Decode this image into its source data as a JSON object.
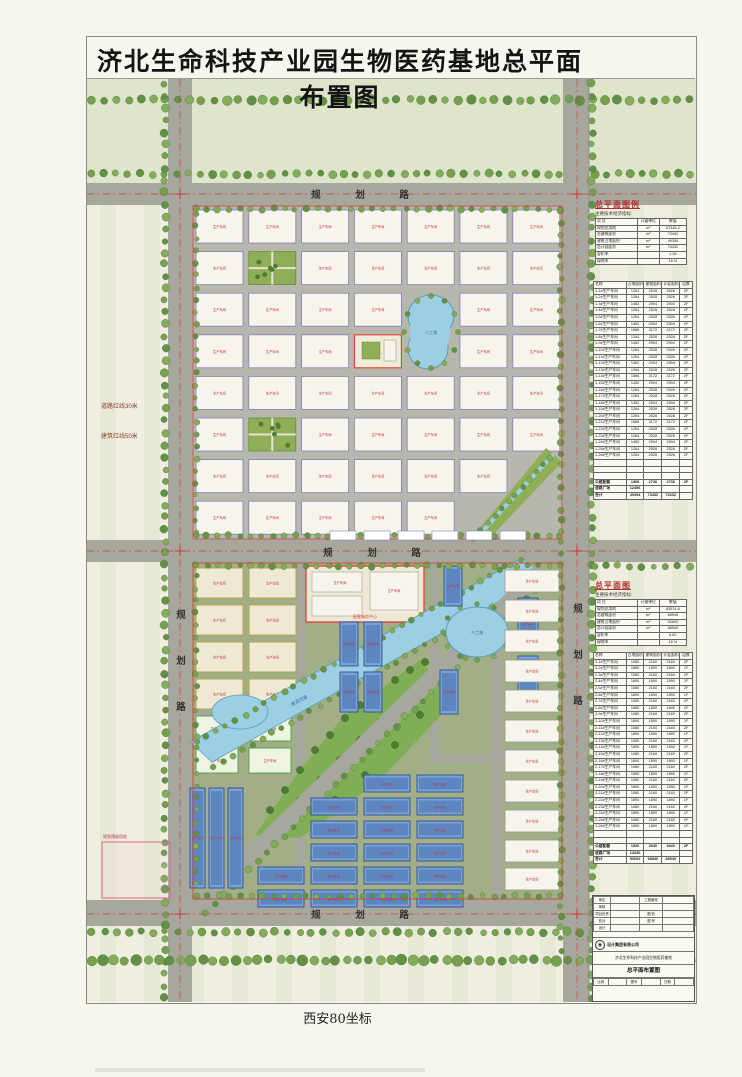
{
  "page": {
    "title": "济北生命科技产业园生物医药基地总平面布置图",
    "caption": "西安80坐标"
  },
  "map": {
    "road_label_top": "规 划 路",
    "road_label_mid": "规 划 路",
    "road_label_bottom": "规 划 路",
    "road_label_left_v": "规划路",
    "road_label_right_v": "规划路",
    "redline_road": "道路红线30米",
    "redline_building": "建筑红线50米",
    "pond_label": "人工湖",
    "lake_label": "人工湖",
    "river_label": "景观河道",
    "service_block_label": "配套服务中心",
    "reserve_note": "规划预留用地",
    "factory_label": "生产车间"
  },
  "colors": {
    "paper": "#efeee0",
    "band": "#dfe5cb",
    "road": "#a7a79d",
    "block_north_bg": "#b7b7ad",
    "block_south_bg": "#a2ae85",
    "building_fill": "#f7f4ec",
    "building_stroke": "#8080c0",
    "olive_stroke": "#b0a43c",
    "green_stroke": "#4aa24a",
    "blue_fill": "#7aa3d4",
    "blue_dark": "#5d86c0",
    "blue_stroke": "#2f4f8f",
    "water": "#9ccfe4",
    "water_stroke": "#58a0c0",
    "tree": "#76a050",
    "tree_dark": "#4e7c34",
    "lawn": "#8fae55",
    "red_accent": "#c03040",
    "red_line": "#cc4444",
    "heading_red": "#b03030"
  },
  "sidebar": {
    "section1": {
      "heading": "总平面图例",
      "note": "主要技术经济指标:",
      "indicator": {
        "headers": [
          "项 目",
          "计量单位",
          "数值"
        ],
        "rows": [
          [
            "规划总用地",
            "m²",
            "57316.2"
          ],
          [
            "总建筑面积",
            "m²",
            "73432"
          ],
          [
            "建筑占地面积",
            "m²",
            "49354"
          ],
          [
            "总计容面积",
            "m²",
            "73432"
          ],
          [
            "容积率",
            "",
            "1.28"
          ],
          [
            "绿地率",
            "",
            "16 %"
          ]
        ]
      },
      "schedule": {
        "headers": [
          "名称",
          "占地面积(m²)",
          "建筑面积(m²)",
          "计容面积(m²)",
          "层数"
        ],
        "rows": [
          [
            "1-1#生产车间",
            "1264",
            "2528",
            "2528",
            "2F"
          ],
          [
            "1-2#生产车间",
            "1264",
            "2528",
            "2528",
            "2F"
          ],
          [
            "1-3#生产车间",
            "1452",
            "2904",
            "2904",
            "2F"
          ],
          [
            "1-4#生产车间",
            "1264",
            "2528",
            "2528",
            "2F"
          ],
          [
            "1-5#生产车间",
            "1264",
            "2528",
            "2528",
            "2F"
          ],
          [
            "1-6#生产车间",
            "1452",
            "2904",
            "2904",
            "2F"
          ],
          [
            "1-7#生产车间",
            "1586",
            "3172",
            "3172",
            "2F"
          ],
          [
            "1-8#生产车间",
            "1264",
            "2528",
            "2528",
            "2F"
          ],
          [
            "1-9#生产车间",
            "1452",
            "2904",
            "2904",
            "2F"
          ],
          [
            "1-10#生产车间",
            "1264",
            "2528",
            "2528",
            "2F"
          ],
          [
            "1-11#生产车间",
            "1264",
            "2528",
            "2528",
            "2F"
          ],
          [
            "1-12#生产车间",
            "1452",
            "2904",
            "2904",
            "2F"
          ],
          [
            "1-13#生产车间",
            "1264",
            "2528",
            "2528",
            "2F"
          ],
          [
            "1-14#生产车间",
            "1586",
            "3172",
            "3172",
            "2F"
          ],
          [
            "1-15#生产车间",
            "1452",
            "2904",
            "2904",
            "2F"
          ],
          [
            "1-16#生产车间",
            "1264",
            "2528",
            "2528",
            "2F"
          ],
          [
            "1-17#生产车间",
            "1264",
            "2528",
            "2528",
            "2F"
          ],
          [
            "1-18#生产车间",
            "1452",
            "2904",
            "2904",
            "2F"
          ],
          [
            "1-19#生产车间",
            "1264",
            "2528",
            "2528",
            "2F"
          ],
          [
            "1-20#生产车间",
            "1264",
            "2528",
            "2528",
            "2F"
          ],
          [
            "1-21#生产车间",
            "1586",
            "3172",
            "3172",
            "2F"
          ],
          [
            "1-22#生产车间",
            "1264",
            "2528",
            "2528",
            "2F"
          ],
          [
            "1-23#生产车间",
            "1264",
            "2528",
            "2528",
            "2F"
          ],
          [
            "1-24#生产车间",
            "1452",
            "2904",
            "2904",
            "2F"
          ],
          [
            "1-25#生产车间",
            "1264",
            "2528",
            "2528",
            "2F"
          ],
          [
            "1-26#生产车间",
            "1264",
            "2528",
            "2528",
            "2F"
          ]
        ],
        "empty_rows": 3,
        "summary": [
          [
            "公建配套",
            "1368",
            "2736",
            "2736",
            "2F"
          ],
          [
            "道路广场",
            "12456",
            "",
            "",
            ""
          ],
          [
            "合计",
            "49354",
            "73432",
            "73432",
            ""
          ]
        ]
      }
    },
    "section2": {
      "heading": "总平面图",
      "note": "主要技术经济指标:",
      "indicator": {
        "headers": [
          "项 目",
          "计量单位",
          "数值"
        ],
        "rows": [
          [
            "规划总用地",
            "m²",
            "83574.6"
          ],
          [
            "总建筑面积",
            "m²",
            "68940"
          ],
          [
            "建筑占地面积",
            "m²",
            "53692"
          ],
          [
            "总计容面积",
            "m²",
            "68940"
          ],
          [
            "容积率",
            "",
            "0.82"
          ],
          [
            "绿地率",
            "",
            "18 %"
          ]
        ]
      },
      "schedule": {
        "headers": [
          "名称",
          "占地面积(m²)",
          "建筑面积(m²)",
          "计容面积(m²)",
          "层数"
        ],
        "rows": [
          [
            "2-1#生产车间",
            "1080",
            "2160",
            "2160",
            "2F"
          ],
          [
            "2-2#生产车间",
            "1890",
            "1890",
            "1890",
            "1F"
          ],
          [
            "2-3#生产车间",
            "1080",
            "2160",
            "2160",
            "2F"
          ],
          [
            "2-4#生产车间",
            "1890",
            "1890",
            "1890",
            "1F"
          ],
          [
            "2-5#生产车间",
            "1080",
            "2160",
            "2160",
            "2F"
          ],
          [
            "2-6#生产车间",
            "1890",
            "1890",
            "1890",
            "1F"
          ],
          [
            "2-7#生产车间",
            "1080",
            "2160",
            "2160",
            "2F"
          ],
          [
            "2-8#生产车间",
            "1890",
            "1890",
            "1890",
            "1F"
          ],
          [
            "2-9#生产车间",
            "1080",
            "2160",
            "2160",
            "2F"
          ],
          [
            "2-10#生产车间",
            "1890",
            "1890",
            "1890",
            "1F"
          ],
          [
            "2-11#生产车间",
            "1080",
            "2160",
            "2160",
            "2F"
          ],
          [
            "2-12#生产车间",
            "1890",
            "1890",
            "1890",
            "1F"
          ],
          [
            "2-13#生产车间",
            "1080",
            "2160",
            "2160",
            "2F"
          ],
          [
            "2-14#生产车间",
            "1890",
            "1890",
            "1890",
            "1F"
          ],
          [
            "2-15#生产车间",
            "1080",
            "2160",
            "2160",
            "2F"
          ],
          [
            "2-16#生产车间",
            "1890",
            "1890",
            "1890",
            "1F"
          ],
          [
            "2-17#生产车间",
            "1080",
            "2160",
            "2160",
            "2F"
          ],
          [
            "2-18#生产车间",
            "1890",
            "1890",
            "1890",
            "1F"
          ],
          [
            "2-19#生产车间",
            "1080",
            "2160",
            "2160",
            "2F"
          ],
          [
            "2-20#生产车间",
            "1890",
            "1890",
            "1890",
            "1F"
          ],
          [
            "2-21#生产车间",
            "1080",
            "2160",
            "2160",
            "2F"
          ],
          [
            "2-22#生产车间",
            "1890",
            "1890",
            "1890",
            "1F"
          ],
          [
            "2-23#生产车间",
            "1080",
            "2160",
            "2160",
            "2F"
          ],
          [
            "2-24#生产车间",
            "1890",
            "1890",
            "1890",
            "1F"
          ],
          [
            "2-25#生产车间",
            "1080",
            "2160",
            "2160",
            "2F"
          ],
          [
            "2-26#生产车间",
            "1890",
            "1890",
            "1890",
            "1F"
          ]
        ],
        "empty_rows": 2,
        "summary": [
          [
            "公建配套",
            "1520",
            "3040",
            "3040",
            "2F"
          ],
          [
            "道路广场",
            "14230",
            "",
            "",
            ""
          ],
          [
            "合计",
            "53692",
            "68940",
            "68940",
            ""
          ]
        ]
      }
    },
    "titleblock": {
      "rows_left": [
        "审定",
        "审核",
        "项目负责",
        "校对",
        "设计"
      ],
      "rows_right": [
        "工程编号",
        "",
        "图 别",
        "图 号",
        ""
      ],
      "company": "设计集团有限公司",
      "project": "济北生命科技产业园生物医药基地",
      "drawing_name": "总平面布置图",
      "bottom_labels": [
        "比例",
        "图号",
        "日期"
      ]
    }
  }
}
